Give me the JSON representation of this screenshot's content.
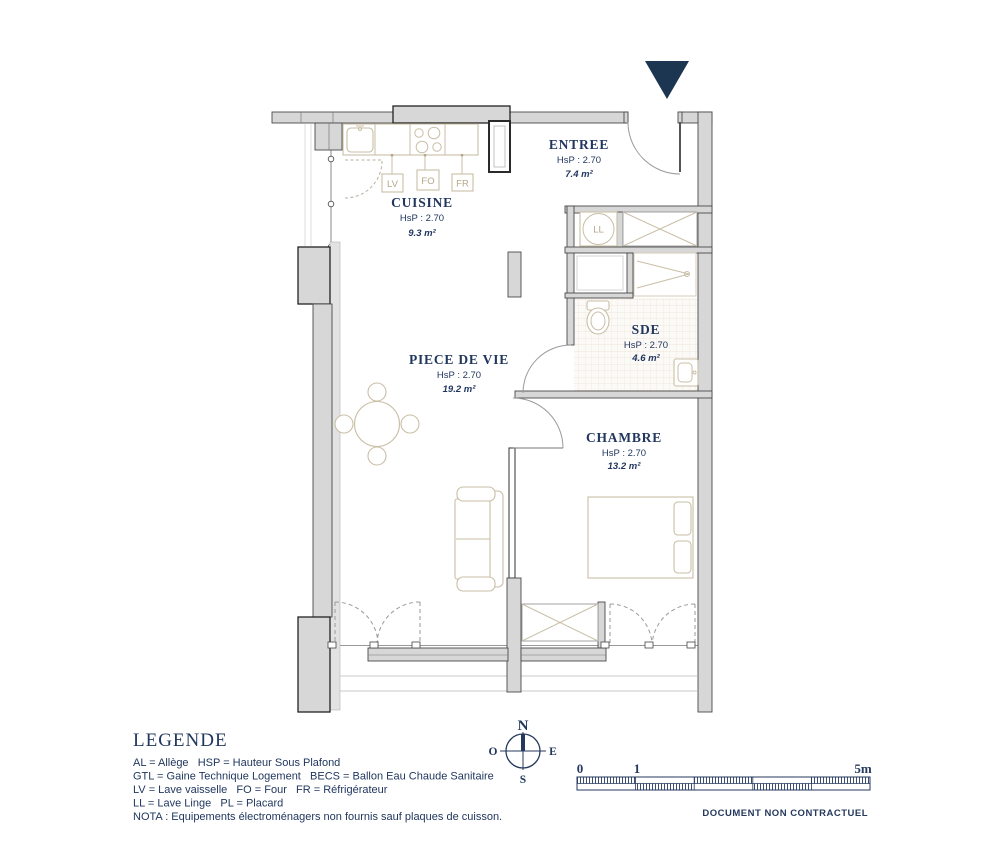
{
  "plan": {
    "rooms": [
      {
        "name": "ENTREE",
        "hsp": "HsP : 2.70",
        "area": "7.4 m²"
      },
      {
        "name": "CUISINE",
        "hsp": "HsP : 2.70",
        "area": "9.3 m²"
      },
      {
        "name": "PIECE DE VIE",
        "hsp": "HsP : 2.70",
        "area": "19.2 m²"
      },
      {
        "name": "SDE",
        "hsp": "HsP : 2.70",
        "area": "4.6 m²"
      },
      {
        "name": "CHAMBRE",
        "hsp": "HsP : 2.70",
        "area": "13.2 m²"
      }
    ],
    "appliance_labels": {
      "lv": "LV",
      "fo": "FO",
      "fr": "FR",
      "ll": "LL"
    }
  },
  "legend": {
    "title": "LEGENDE",
    "lines": [
      "AL = Allège   HSP = Hauteur Sous Plafond",
      "GTL = Gaine Technique Logement   BECS = Ballon Eau Chaude Sanitaire",
      "LV = Lave vaisselle   FO = Four   FR = Réfrigérateur",
      "LL = Lave Linge   PL = Placard",
      "NOTA : Equipements électroménagers non fournis sauf plaques de cuisson."
    ]
  },
  "compass": {
    "north": "N",
    "south": "S",
    "east": "E",
    "west": "O"
  },
  "scale_bar": {
    "tick_0": "0",
    "tick_1": "1",
    "tick_5": "5m"
  },
  "footer": {
    "disclaimer": "DOCUMENT NON CONTRACTUEL"
  },
  "colors": {
    "accent_navy": "#21375f",
    "wall_gray": "#d7d7d7",
    "furniture_tan": "#c9bfa6"
  }
}
